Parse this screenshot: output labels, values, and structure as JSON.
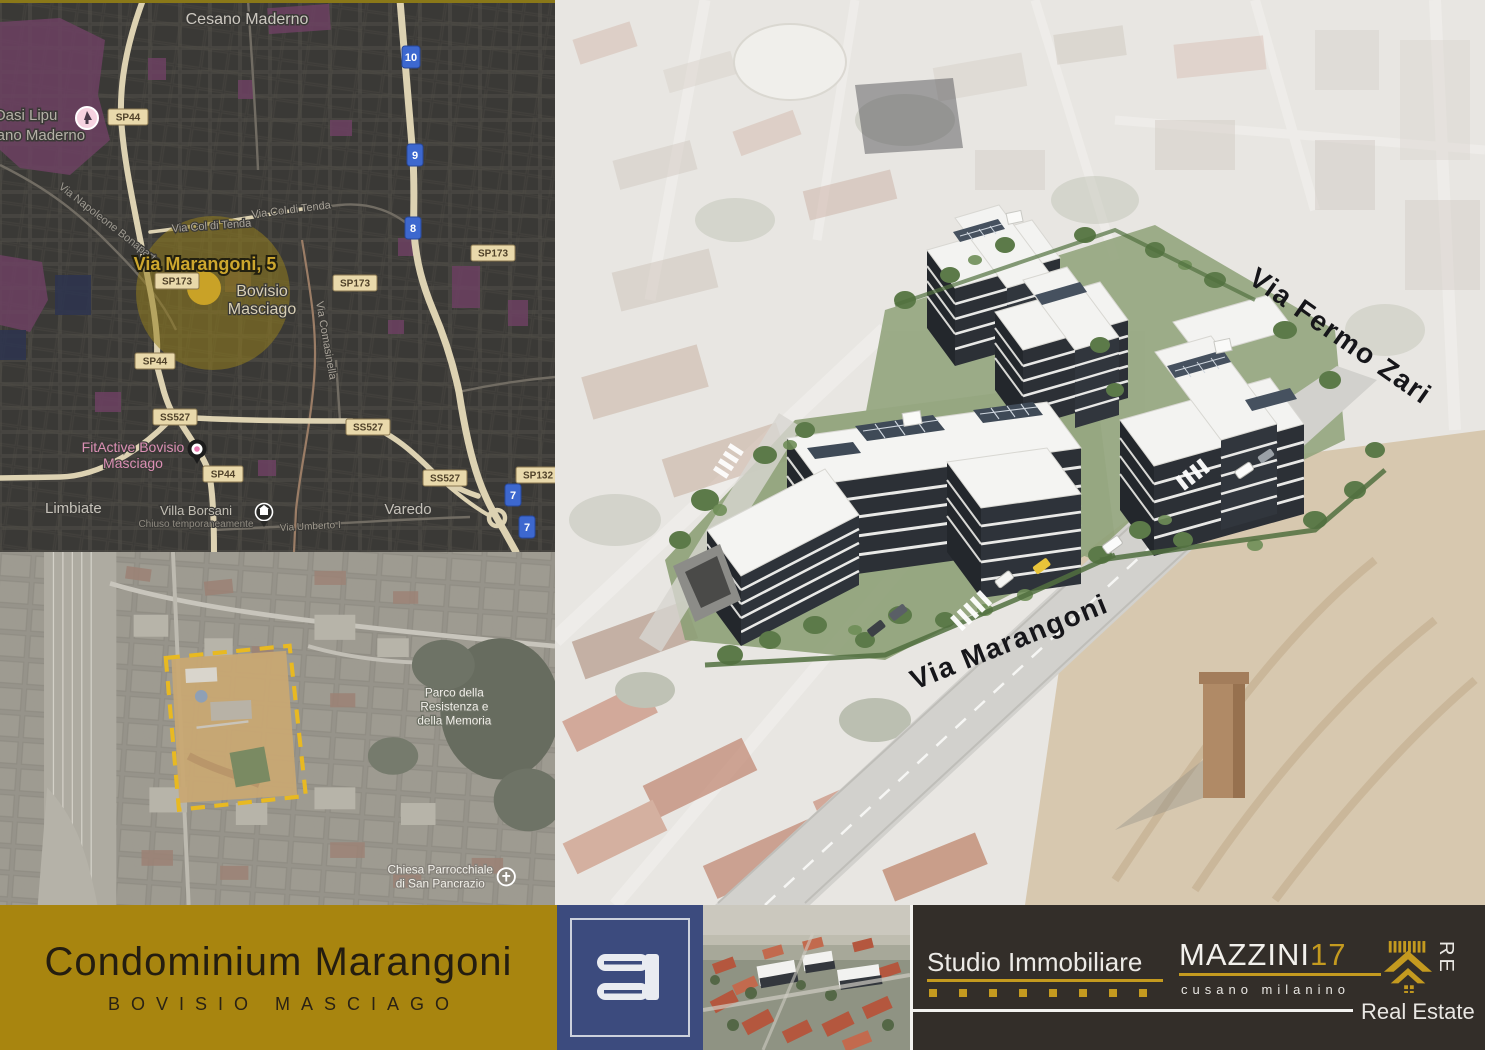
{
  "map": {
    "city_top": "Cesano Maderno",
    "poi_oasi_line1": "Oasi Lipu",
    "poi_oasi_line2": "Cesano Maderno",
    "street_napoleone": "Via Napoleone Bonaparte",
    "street_coltenda_1": "Via Col di Tenda",
    "street_coltenda_2": "Via Col di Tenda",
    "marker_title": "Via Marangoni, 5",
    "city_bovisio_line1": "Bovisio",
    "city_bovisio_line2": "Masciago",
    "street_comasinella": "Via Comasinella",
    "poi_fitactive_line1": "FitActive Bovisio",
    "poi_fitactive_line2": "Masciago",
    "city_limbiate": "Limbiate",
    "poi_villa": "Villa Borsani",
    "poi_villa_sub": "Chiuso temporaneamente",
    "street_umberto": "Via Umberto I",
    "city_varedo": "Varedo",
    "badges": [
      "SP44",
      "SP173",
      "SP173",
      "SP173",
      "SP44",
      "SS527",
      "SS527",
      "SS527",
      "SP44",
      "SP132"
    ],
    "routes": [
      "10",
      "9",
      "8",
      "7",
      "7"
    ]
  },
  "satellite": {
    "parco_line1": "Parco della",
    "parco_line2": "Resistenza e",
    "parco_line3": "della Memoria",
    "chiesa_line1": "Chiesa Parrocchiale",
    "chiesa_line2": "di San Pancrazio"
  },
  "render": {
    "street_fermo": "Via Fermo Zari",
    "street_marangoni": "Via Marangoni"
  },
  "footer": {
    "title": "Condominium Marangoni",
    "subtitle": "BOVISIO MASCIAGO",
    "agency_name": "Studio Immobiliare",
    "brand": "MAZZINI",
    "brand_number": "17",
    "brand_location": "cusano milanino",
    "brand_re": "RE",
    "brand_tagline": "Real Estate"
  },
  "colors": {
    "gold_band": "#a8850f",
    "brand_gold": "#c49a1f",
    "logo_blue": "#3c4b7e",
    "band_dark": "#332e29",
    "map_highlight": "#c9a227"
  }
}
